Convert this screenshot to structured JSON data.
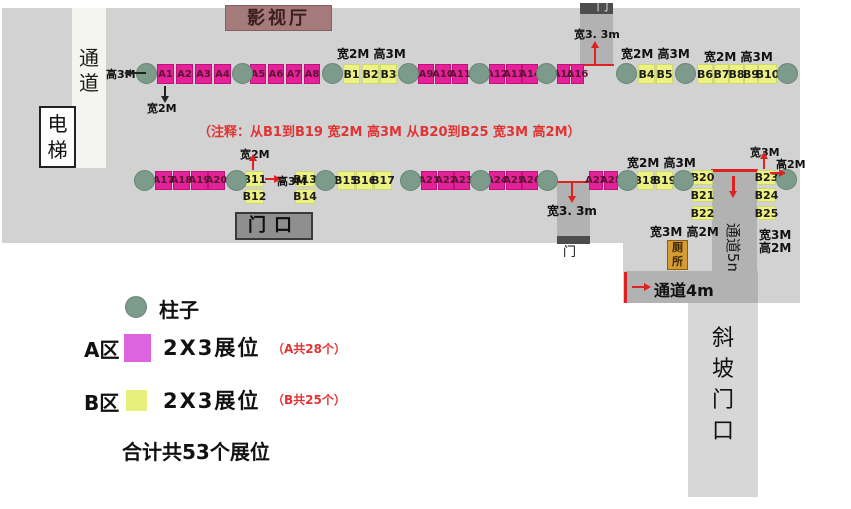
{
  "colors": {
    "floor": "#d2d2d2",
    "corridor_dark": "#b2b2b2",
    "booth_a": "#e32198",
    "booth_b": "#eef283",
    "pillar": "#7d9b8b",
    "red": "#dd2222"
  },
  "areas": {
    "cinema": "影视厅",
    "corridor_left": "通\n道",
    "elevator": "电\n梯",
    "gate": "门口",
    "door_top": "门",
    "door_mid": "门",
    "toilet": "厕\n所",
    "corridor5": "通道5m",
    "corridor4": "通道4m",
    "slope": "斜\n坡\n门\n口"
  },
  "note": "（注释：从B1到B19 宽2M 高3M  从B20到B25 宽3M 高2M）",
  "dims": {
    "h3m_row1": "高3M",
    "w2m_a1": "宽2M",
    "w2h3_b1": "宽2M 高3M",
    "w2h3_b4": "宽2M 高3M",
    "w2h3_b6": "宽2M 高3M",
    "w33_top": "宽3. 3m",
    "w33_mid": "宽3. 3m",
    "w2m_b11": "宽2M",
    "h3m_b11": "高3M",
    "w2h3_b18": "宽2M 高3M",
    "w3h2_b22": "宽3M 高2M",
    "w3m_b23": "宽3M",
    "h2m_b23": "高2M",
    "w3m_b25": "宽3M",
    "h2m_b25": "高2M"
  },
  "booths": {
    "a": [
      {
        "id": "A1",
        "x": 157,
        "y": 64,
        "w": 17,
        "h": 20
      },
      {
        "id": "A2",
        "x": 176,
        "y": 64,
        "w": 17,
        "h": 20
      },
      {
        "id": "A3",
        "x": 195,
        "y": 64,
        "w": 17,
        "h": 20
      },
      {
        "id": "A4",
        "x": 214,
        "y": 64,
        "w": 17,
        "h": 20
      },
      {
        "id": "A5",
        "x": 250,
        "y": 64,
        "w": 16,
        "h": 20
      },
      {
        "id": "A6",
        "x": 268,
        "y": 64,
        "w": 16,
        "h": 20
      },
      {
        "id": "A7",
        "x": 286,
        "y": 64,
        "w": 16,
        "h": 20
      },
      {
        "id": "A8",
        "x": 304,
        "y": 64,
        "w": 16,
        "h": 20
      },
      {
        "id": "A9",
        "x": 418,
        "y": 64,
        "w": 16,
        "h": 20
      },
      {
        "id": "A10",
        "x": 435,
        "y": 64,
        "w": 16,
        "h": 20
      },
      {
        "id": "A11",
        "x": 452,
        "y": 64,
        "w": 16,
        "h": 20
      },
      {
        "id": "A12",
        "x": 489,
        "y": 64,
        "w": 16,
        "h": 20
      },
      {
        "id": "A13",
        "x": 506,
        "y": 64,
        "w": 16,
        "h": 20
      },
      {
        "id": "A14",
        "x": 522,
        "y": 64,
        "w": 16,
        "h": 20
      },
      {
        "id": "A15",
        "x": 557,
        "y": 64,
        "w": 13,
        "h": 20
      },
      {
        "id": "A16",
        "x": 571,
        "y": 64,
        "w": 13,
        "h": 20
      },
      {
        "id": "A17",
        "x": 155,
        "y": 171,
        "w": 17,
        "h": 19
      },
      {
        "id": "A18",
        "x": 173,
        "y": 171,
        "w": 17,
        "h": 19
      },
      {
        "id": "A19",
        "x": 191,
        "y": 171,
        "w": 17,
        "h": 19
      },
      {
        "id": "A20",
        "x": 208,
        "y": 171,
        "w": 17,
        "h": 19
      },
      {
        "id": "A21",
        "x": 421,
        "y": 171,
        "w": 16,
        "h": 19
      },
      {
        "id": "A22",
        "x": 438,
        "y": 171,
        "w": 16,
        "h": 19
      },
      {
        "id": "A23",
        "x": 454,
        "y": 171,
        "w": 16,
        "h": 19
      },
      {
        "id": "A24",
        "x": 489,
        "y": 171,
        "w": 16,
        "h": 19
      },
      {
        "id": "A25",
        "x": 506,
        "y": 171,
        "w": 16,
        "h": 19
      },
      {
        "id": "A26",
        "x": 522,
        "y": 171,
        "w": 16,
        "h": 19
      },
      {
        "id": "A27",
        "x": 589,
        "y": 171,
        "w": 14,
        "h": 19
      },
      {
        "id": "A28",
        "x": 604,
        "y": 171,
        "w": 14,
        "h": 19
      }
    ],
    "b": [
      {
        "id": "B1",
        "x": 343,
        "y": 64,
        "w": 17,
        "h": 20
      },
      {
        "id": "B2",
        "x": 362,
        "y": 64,
        "w": 17,
        "h": 20
      },
      {
        "id": "B3",
        "x": 380,
        "y": 64,
        "w": 17,
        "h": 20
      },
      {
        "id": "B4",
        "x": 638,
        "y": 64,
        "w": 17,
        "h": 20
      },
      {
        "id": "B5",
        "x": 656,
        "y": 64,
        "w": 17,
        "h": 20
      },
      {
        "id": "B6",
        "x": 697,
        "y": 64,
        "w": 16,
        "h": 20
      },
      {
        "id": "B7",
        "x": 714,
        "y": 64,
        "w": 15,
        "h": 20
      },
      {
        "id": "B8",
        "x": 729,
        "y": 64,
        "w": 15,
        "h": 20
      },
      {
        "id": "B9",
        "x": 744,
        "y": 64,
        "w": 14,
        "h": 20
      },
      {
        "id": "B10",
        "x": 758,
        "y": 64,
        "w": 19,
        "h": 20
      },
      {
        "id": "B11",
        "x": 245,
        "y": 171,
        "w": 19,
        "h": 16
      },
      {
        "id": "B12",
        "x": 245,
        "y": 189,
        "w": 19,
        "h": 15
      },
      {
        "id": "B13",
        "x": 295,
        "y": 171,
        "w": 20,
        "h": 16
      },
      {
        "id": "B14",
        "x": 295,
        "y": 189,
        "w": 20,
        "h": 15
      },
      {
        "id": "B15",
        "x": 337,
        "y": 171,
        "w": 18,
        "h": 19
      },
      {
        "id": "B16",
        "x": 356,
        "y": 171,
        "w": 17,
        "h": 19
      },
      {
        "id": "B17",
        "x": 374,
        "y": 171,
        "w": 18,
        "h": 19
      },
      {
        "id": "B18",
        "x": 637,
        "y": 171,
        "w": 17,
        "h": 19
      },
      {
        "id": "B19",
        "x": 656,
        "y": 171,
        "w": 17,
        "h": 19
      },
      {
        "id": "B20",
        "x": 692,
        "y": 170,
        "w": 21,
        "h": 15
      },
      {
        "id": "B21",
        "x": 692,
        "y": 188,
        "w": 21,
        "h": 14
      },
      {
        "id": "B22",
        "x": 692,
        "y": 206,
        "w": 21,
        "h": 14
      },
      {
        "id": "B23",
        "x": 757,
        "y": 170,
        "w": 19,
        "h": 15
      },
      {
        "id": "B24",
        "x": 757,
        "y": 188,
        "w": 19,
        "h": 14
      },
      {
        "id": "B25",
        "x": 757,
        "y": 206,
        "w": 19,
        "h": 14
      }
    ]
  },
  "pillars": [
    {
      "x": 136,
      "y": 63
    },
    {
      "x": 232,
      "y": 63
    },
    {
      "x": 322,
      "y": 63
    },
    {
      "x": 398,
      "y": 63
    },
    {
      "x": 469,
      "y": 63
    },
    {
      "x": 536,
      "y": 63
    },
    {
      "x": 616,
      "y": 63
    },
    {
      "x": 675,
      "y": 63
    },
    {
      "x": 777,
      "y": 63
    },
    {
      "x": 134,
      "y": 170
    },
    {
      "x": 226,
      "y": 170
    },
    {
      "x": 315,
      "y": 170
    },
    {
      "x": 400,
      "y": 170
    },
    {
      "x": 470,
      "y": 170
    },
    {
      "x": 537,
      "y": 170
    },
    {
      "x": 617,
      "y": 170
    },
    {
      "x": 673,
      "y": 170
    },
    {
      "x": 776,
      "y": 169
    }
  ],
  "legend": {
    "pillar_label": "柱子",
    "zone_a": "A区",
    "zone_a_booth": "2X3展位",
    "zone_a_count": "（A共28个）",
    "zone_b": "B区",
    "zone_b_booth": "2X3展位",
    "zone_b_count": "（B共25个）",
    "total": "合计共53个展位"
  }
}
